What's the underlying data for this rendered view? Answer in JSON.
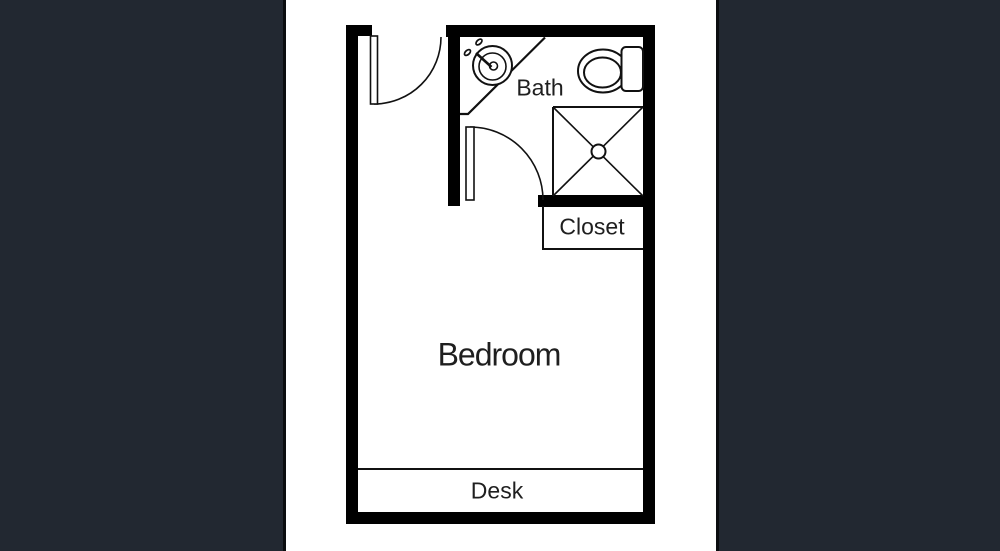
{
  "image": {
    "kind": "architectural floor plan",
    "description": "Studio floor plan with bedroom, bathroom, closet and desk nook, shown on white strip between dark side panels"
  },
  "colors": {
    "side_panel": "#222831",
    "panel_edge_line": "#0b0d10",
    "floor": "#ffffff",
    "wall": "#000000",
    "thin_line": "#111111",
    "text": "#1f1f1f"
  },
  "rooms": {
    "bath": {
      "label": "Bath"
    },
    "closet": {
      "label": "Closet"
    },
    "bedroom": {
      "label": "Bedroom"
    },
    "desk": {
      "label": "Desk"
    }
  },
  "fixtures": [
    "sink-icon",
    "toilet-icon",
    "shower-icon",
    "entry-door-swing",
    "bath-door-swing"
  ]
}
